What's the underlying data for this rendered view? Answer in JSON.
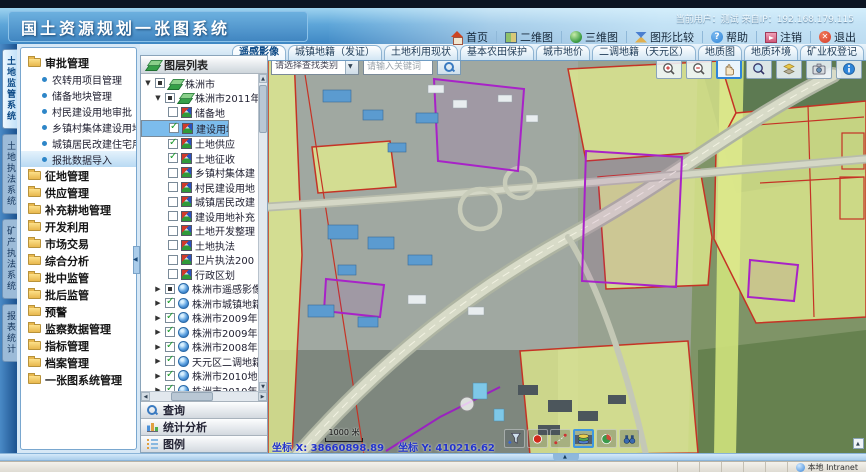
{
  "header": {
    "title": "国土资源规划一张图系统",
    "user_info": "当前用户：测试    来自IP：192.168.179.115"
  },
  "toolbar": {
    "buttons": [
      {
        "label": "首页",
        "icon": "home-icon"
      },
      {
        "label": "二维图",
        "icon": "map-2d-icon"
      },
      {
        "label": "三维图",
        "icon": "globe-3d-icon"
      },
      {
        "label": "图形比较",
        "icon": "compare-icon"
      },
      {
        "label": "帮助",
        "icon": "help-icon"
      },
      {
        "label": "注销",
        "icon": "logout-icon"
      },
      {
        "label": "退出",
        "icon": "exit-icon"
      }
    ]
  },
  "tabs": [
    {
      "label": "遥感影像",
      "active": true
    },
    {
      "label": "城镇地籍（发证）",
      "active": false
    },
    {
      "label": "土地利用现状",
      "active": false
    },
    {
      "label": "基本农田保护",
      "active": false
    },
    {
      "label": "城市地价",
      "active": false
    },
    {
      "label": "二调地籍（天元区）",
      "active": false
    },
    {
      "label": "地质图",
      "active": false
    },
    {
      "label": "地质环境",
      "active": false
    },
    {
      "label": "矿业权登记",
      "active": false
    }
  ],
  "side_tabs": [
    {
      "label": "土地监管系统",
      "active": true
    },
    {
      "label": "土地执法系统",
      "active": false
    },
    {
      "label": "矿产执法系统",
      "active": false
    },
    {
      "label": "报表统计",
      "active": false
    }
  ],
  "menu": {
    "groups": [
      {
        "label": "审批管理",
        "expanded": true,
        "children": [
          "农转用项目管理",
          "储备地块管理",
          "村民建设用地审批",
          "乡镇村集体建设用地",
          "城镇居民改建住宅用地",
          "报批数据导入"
        ],
        "highlighted_child": "报批数据导入"
      },
      {
        "label": "征地管理"
      },
      {
        "label": "供应管理"
      },
      {
        "label": "补充耕地管理"
      },
      {
        "label": "开发利用"
      },
      {
        "label": "市场交易"
      },
      {
        "label": "综合分析"
      },
      {
        "label": "批中监管"
      },
      {
        "label": "批后监管"
      },
      {
        "label": "预警"
      },
      {
        "label": "监察数据管理"
      },
      {
        "label": "指标管理"
      },
      {
        "label": "档案管理"
      },
      {
        "label": "一张图系统管理"
      }
    ]
  },
  "layers": {
    "title": "图层列表",
    "tree": [
      {
        "label": "株洲市",
        "level": 0,
        "expanded": true,
        "checked": "partial",
        "icon": "layers-icon"
      },
      {
        "label": "株洲市2011年用地",
        "level": 1,
        "expanded": true,
        "checked": "partial",
        "icon": "layers-icon"
      },
      {
        "label": "储备地",
        "level": 2,
        "checked": "off",
        "icon": "map-layer-icon"
      },
      {
        "label": "建设用地审批",
        "level": 2,
        "checked": "on",
        "icon": "map-layer-icon",
        "selected": true
      },
      {
        "label": "土地供应",
        "level": 2,
        "checked": "on",
        "icon": "map-layer-icon"
      },
      {
        "label": "土地征收",
        "level": 2,
        "checked": "on",
        "icon": "map-layer-icon"
      },
      {
        "label": "乡镇村集体建",
        "level": 2,
        "checked": "off",
        "icon": "map-layer-icon"
      },
      {
        "label": "村民建设用地",
        "level": 2,
        "checked": "off",
        "icon": "map-layer-icon"
      },
      {
        "label": "城镇居民改建",
        "level": 2,
        "checked": "off",
        "icon": "map-layer-icon"
      },
      {
        "label": "建设用地补充",
        "level": 2,
        "checked": "off",
        "icon": "map-layer-icon"
      },
      {
        "label": "土地开发整理",
        "level": 2,
        "checked": "off",
        "icon": "map-layer-icon"
      },
      {
        "label": "土地执法",
        "level": 2,
        "checked": "off",
        "icon": "map-layer-icon"
      },
      {
        "label": "卫片执法200",
        "level": 2,
        "checked": "off",
        "icon": "map-layer-icon"
      },
      {
        "label": "行政区划",
        "level": 2,
        "checked": "off",
        "icon": "map-layer-icon"
      },
      {
        "label": "株洲市遥感影像",
        "level": 1,
        "expanded": false,
        "checked": "partial",
        "icon": "globe-icon"
      },
      {
        "label": "株洲市城镇地籍",
        "level": 1,
        "expanded": false,
        "checked": "on",
        "icon": "globe-icon"
      },
      {
        "label": "株洲市2009年土地利用",
        "level": 1,
        "expanded": false,
        "checked": "on",
        "icon": "globe-icon"
      },
      {
        "label": "株洲市2009年基本农田",
        "level": 1,
        "expanded": false,
        "checked": "on",
        "icon": "globe-icon"
      },
      {
        "label": "株洲市2008年地价",
        "level": 1,
        "expanded": false,
        "checked": "on",
        "icon": "globe-icon"
      },
      {
        "label": "天元区二调地籍",
        "level": 1,
        "expanded": false,
        "checked": "on",
        "icon": "globe-icon"
      },
      {
        "label": "株洲市2010地质图",
        "level": 1,
        "expanded": false,
        "checked": "on",
        "icon": "globe-icon"
      },
      {
        "label": "株洲市2010年矿山地质",
        "level": 1,
        "expanded": false,
        "checked": "on",
        "icon": "globe-icon"
      }
    ],
    "accordion": [
      {
        "label": "查询",
        "icon": "search-icon"
      },
      {
        "label": "统计分析",
        "icon": "chart-icon"
      },
      {
        "label": "图例",
        "icon": "legend-icon"
      }
    ]
  },
  "map": {
    "search_category": "请选择查找类别",
    "search_placeholder": "请输入关键词",
    "scale_label": "1000 米",
    "coord_x": "坐标 X: 38660898.89",
    "coord_y": "坐标 Y: 410216.62",
    "tools": [
      {
        "icon": "zoom-in-icon",
        "active": false
      },
      {
        "icon": "zoom-out-icon",
        "active": false
      },
      {
        "icon": "pan-hand-icon",
        "active": true
      },
      {
        "icon": "identify-icon",
        "active": false
      },
      {
        "icon": "overview-icon",
        "active": false
      },
      {
        "icon": "snapshot-icon",
        "active": false
      },
      {
        "icon": "info-icon",
        "active": false
      }
    ],
    "bottom_tools": [
      {
        "icon": "filter-funnel-icon",
        "active": false
      },
      {
        "icon": "select-point-icon",
        "active": false
      },
      {
        "icon": "measure-distance-icon",
        "active": false
      },
      {
        "icon": "layers-3d-icon",
        "active": true
      },
      {
        "icon": "legend-globe-icon",
        "active": false
      },
      {
        "icon": "binoculars-icon",
        "active": false
      }
    ]
  },
  "statusbar": {
    "zone": "本地 Intranet"
  }
}
